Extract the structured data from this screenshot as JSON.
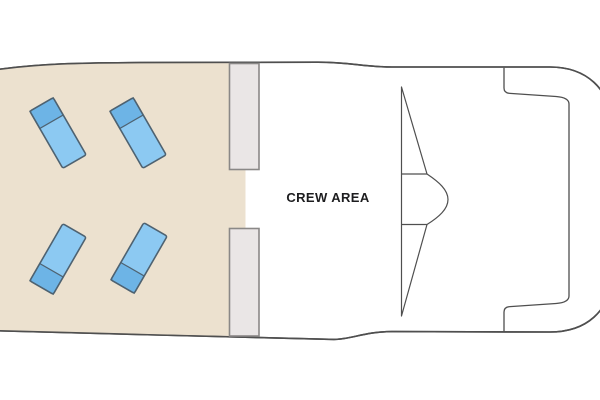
{
  "diagram": {
    "type": "boat-deck-plan",
    "labels": {
      "crew_area": "CREW AREA"
    },
    "areas": {
      "sun_deck": {
        "name": "sun deck with loungers",
        "lounger_count": 4
      },
      "crew_area": {
        "name": "crew area"
      }
    },
    "loungers": [
      {
        "cx": 58,
        "cy": 133,
        "rotation": -30,
        "pillow": "top"
      },
      {
        "cx": 138,
        "cy": 133,
        "rotation": -30,
        "pillow": "top"
      },
      {
        "cx": 58,
        "cy": 259,
        "rotation": 30,
        "pillow": "bottom"
      },
      {
        "cx": 139,
        "cy": 258,
        "rotation": 30,
        "pillow": "bottom"
      }
    ],
    "lounger_dims": {
      "width": 27,
      "length": 66,
      "pillow_depth": 20,
      "corner_radius": 2
    },
    "colors": {
      "deck_beige": "#ece1cf",
      "hull_fill": "#ffffff",
      "outline": "#4f4f4f",
      "bulkhead_fill": "#eae6e6",
      "bulkhead_border": "#8a8887",
      "lounger_body": "#8cc9f2",
      "lounger_pillow": "#6db4e6",
      "lounger_border": "#4e6271",
      "label_color": "#1d1d1f"
    }
  }
}
